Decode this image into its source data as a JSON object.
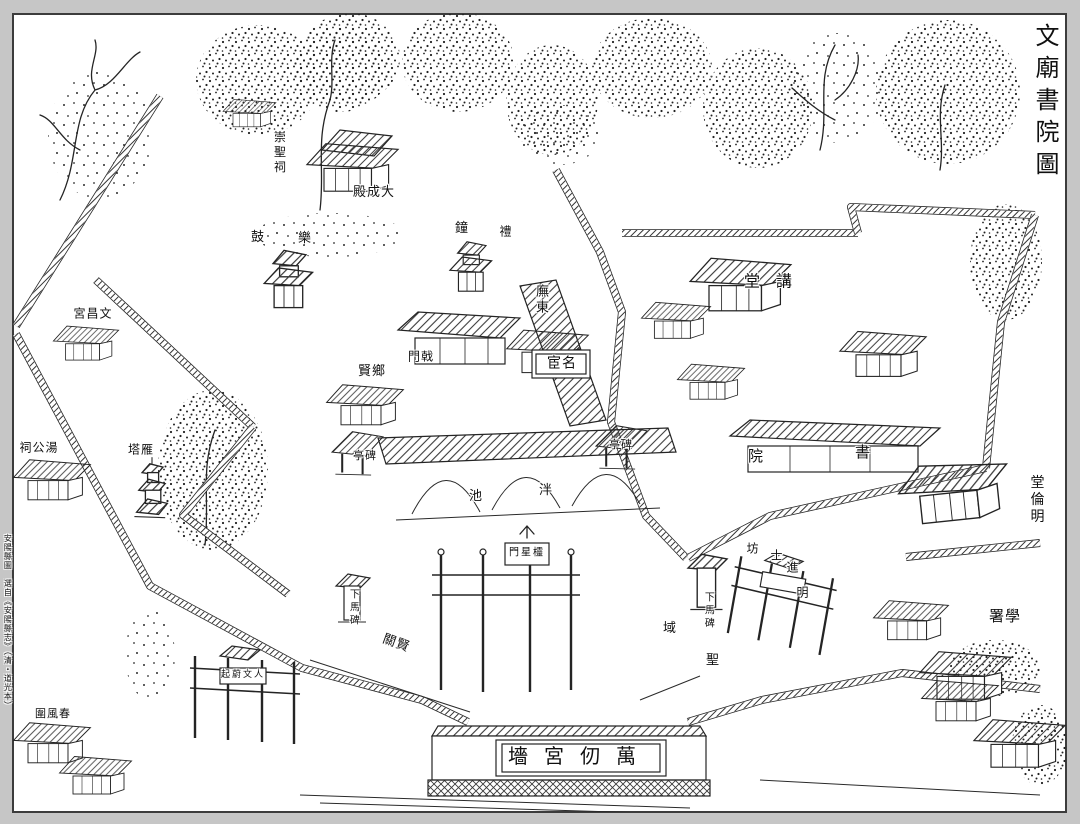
{
  "page": {
    "kind": "woodblock pictorial map of a Confucian temple and academy compound",
    "title_reading": "文廟書院圖"
  },
  "colors": {
    "ink": "#1a1a1a",
    "paper": "#ffffff",
    "surround": "#c6c6c6"
  },
  "labels": [
    {
      "id": "title",
      "display": "文廟書院圖",
      "reading": "文廟書院圖",
      "orient": "v",
      "x": 1044,
      "y": 103,
      "size": 24,
      "spacing": 8
    },
    {
      "id": "margin-caption",
      "display": "安陽縣圖　選自《安陽縣志》（清・道光本）",
      "reading": "安陽縣圖 選自《安陽縣志》（清・道光本）",
      "orient": "v",
      "x": 7,
      "y": 622,
      "size": 8,
      "spacing": 1
    },
    {
      "id": "chongsheng-shrine",
      "display": "崇聖祠",
      "reading": "崇聖祠",
      "orient": "v",
      "x": 279,
      "y": 153,
      "size": 12
    },
    {
      "id": "dacheng-hall",
      "display": "殿成大",
      "reading": "大成殿",
      "orient": "h",
      "x": 374,
      "y": 193,
      "size": 13
    },
    {
      "id": "drum-tower",
      "display": "鼓",
      "reading": "鼓",
      "orient": "h",
      "x": 258,
      "y": 238,
      "size": 13
    },
    {
      "id": "music-tower",
      "display": "樂",
      "reading": "樂",
      "orient": "h",
      "x": 305,
      "y": 239,
      "size": 13
    },
    {
      "id": "bell-tower",
      "display": "鐘",
      "reading": "鐘",
      "orient": "h",
      "x": 462,
      "y": 229,
      "size": 13
    },
    {
      "id": "li-gate",
      "display": "禮",
      "reading": "禮",
      "orient": "h",
      "x": 506,
      "y": 232,
      "size": 12
    },
    {
      "id": "east-corridor",
      "display": "廡東",
      "reading": "東廡",
      "orient": "v",
      "x": 540,
      "y": 300,
      "size": 13
    },
    {
      "id": "ji-gate",
      "display": "門戟",
      "reading": "戟門",
      "orient": "h",
      "x": 421,
      "y": 357,
      "size": 12
    },
    {
      "id": "minghuan-shrine",
      "display": "宦名",
      "reading": "名宦",
      "orient": "h",
      "x": 562,
      "y": 364,
      "size": 14
    },
    {
      "id": "xiangxian-shrine",
      "display": "賢鄉",
      "reading": "鄉賢",
      "orient": "h",
      "x": 372,
      "y": 372,
      "size": 13
    },
    {
      "id": "stele-pavilion-west",
      "display": "亭碑",
      "reading": "碑亭",
      "orient": "h",
      "x": 365,
      "y": 456,
      "size": 11
    },
    {
      "id": "stele-pavilion-east",
      "display": "亭碑",
      "reading": "碑亭",
      "orient": "h",
      "x": 621,
      "y": 445,
      "size": 11
    },
    {
      "id": "pan-pond-chi",
      "display": "池",
      "reading": "泮池",
      "orient": "h",
      "x": 476,
      "y": 497,
      "size": 13
    },
    {
      "id": "pan-pond-pan",
      "display": "泮",
      "reading": "泮池",
      "orient": "h",
      "x": 546,
      "y": 491,
      "size": 13
    },
    {
      "id": "lingxing-gate",
      "display": "門星欞",
      "reading": "欞星門",
      "orient": "h",
      "x": 527,
      "y": 554,
      "size": 10,
      "spacing": 2
    },
    {
      "id": "dismount-stele-west",
      "display": "下馬碑",
      "reading": "下馬碑",
      "orient": "v",
      "x": 352,
      "y": 608,
      "size": 10
    },
    {
      "id": "xianguan-gate",
      "display": "關賢",
      "reading": "賢關",
      "orient": "h",
      "x": 396,
      "y": 644,
      "size": 13,
      "rotate": 20
    },
    {
      "id": "dismount-stele-east",
      "display": "下馬碑",
      "reading": "下馬碑",
      "orient": "v",
      "x": 707,
      "y": 611,
      "size": 10
    },
    {
      "id": "shengyu-yu",
      "display": "域",
      "reading": "聖域",
      "orient": "h",
      "x": 670,
      "y": 629,
      "size": 13
    },
    {
      "id": "shengyu-sheng",
      "display": "聖",
      "reading": "聖域",
      "orient": "h",
      "x": 713,
      "y": 661,
      "size": 13
    },
    {
      "id": "ming-jinshi-arch-fang",
      "display": "坊",
      "reading": "明進士坊",
      "orient": "h",
      "x": 753,
      "y": 549,
      "size": 12
    },
    {
      "id": "ming-jinshi-arch-shi",
      "display": "士",
      "reading": "明進士坊",
      "orient": "h",
      "x": 777,
      "y": 556,
      "size": 12
    },
    {
      "id": "ming-jinshi-arch-jin",
      "display": "進",
      "reading": "明進士坊",
      "orient": "h",
      "x": 793,
      "y": 568,
      "size": 12
    },
    {
      "id": "ming-jinshi-arch-ming",
      "display": "明",
      "reading": "明進士坊",
      "orient": "h",
      "x": 803,
      "y": 593,
      "size": 12
    },
    {
      "id": "wanren-palace-wall",
      "display": "墻宮仞萬",
      "reading": "萬仞宮墻",
      "orient": "h",
      "x": 580,
      "y": 757,
      "size": 20,
      "spacing": 16
    },
    {
      "id": "renwen-arch",
      "display": "起蔚文人",
      "reading": "人文蔚起",
      "orient": "h",
      "x": 243,
      "y": 676,
      "size": 9,
      "spacing": 2
    },
    {
      "id": "chunfeng-enclosure",
      "display": "圍風春",
      "reading": "春風圍",
      "orient": "h",
      "x": 53,
      "y": 714,
      "size": 11
    },
    {
      "id": "tanggong-shrine",
      "display": "祠公湯",
      "reading": "湯公祠",
      "orient": "h",
      "x": 39,
      "y": 448,
      "size": 12
    },
    {
      "id": "yanta-pagoda",
      "display": "塔雁",
      "reading": "雁塔",
      "orient": "h",
      "x": 141,
      "y": 450,
      "size": 12
    },
    {
      "id": "wenchang-palace",
      "display": "宮昌文",
      "reading": "文昌宮",
      "orient": "h",
      "x": 93,
      "y": 314,
      "size": 12
    },
    {
      "id": "lecture-hall",
      "display": "堂講",
      "reading": "講堂",
      "orient": "h",
      "x": 776,
      "y": 281,
      "size": 16,
      "spacing": 16
    },
    {
      "id": "academy-yuan",
      "display": "院",
      "reading": "書院",
      "orient": "h",
      "x": 756,
      "y": 456,
      "size": 15
    },
    {
      "id": "academy-shu",
      "display": "書",
      "reading": "書院",
      "orient": "h",
      "x": 863,
      "y": 452,
      "size": 15
    },
    {
      "id": "minglun-hall",
      "display": "堂倫明",
      "reading": "明倫堂",
      "orient": "v",
      "x": 1036,
      "y": 500,
      "size": 14
    },
    {
      "id": "xueshu-office",
      "display": "署學",
      "reading": "學署",
      "orient": "h",
      "x": 1005,
      "y": 616,
      "size": 15
    }
  ]
}
